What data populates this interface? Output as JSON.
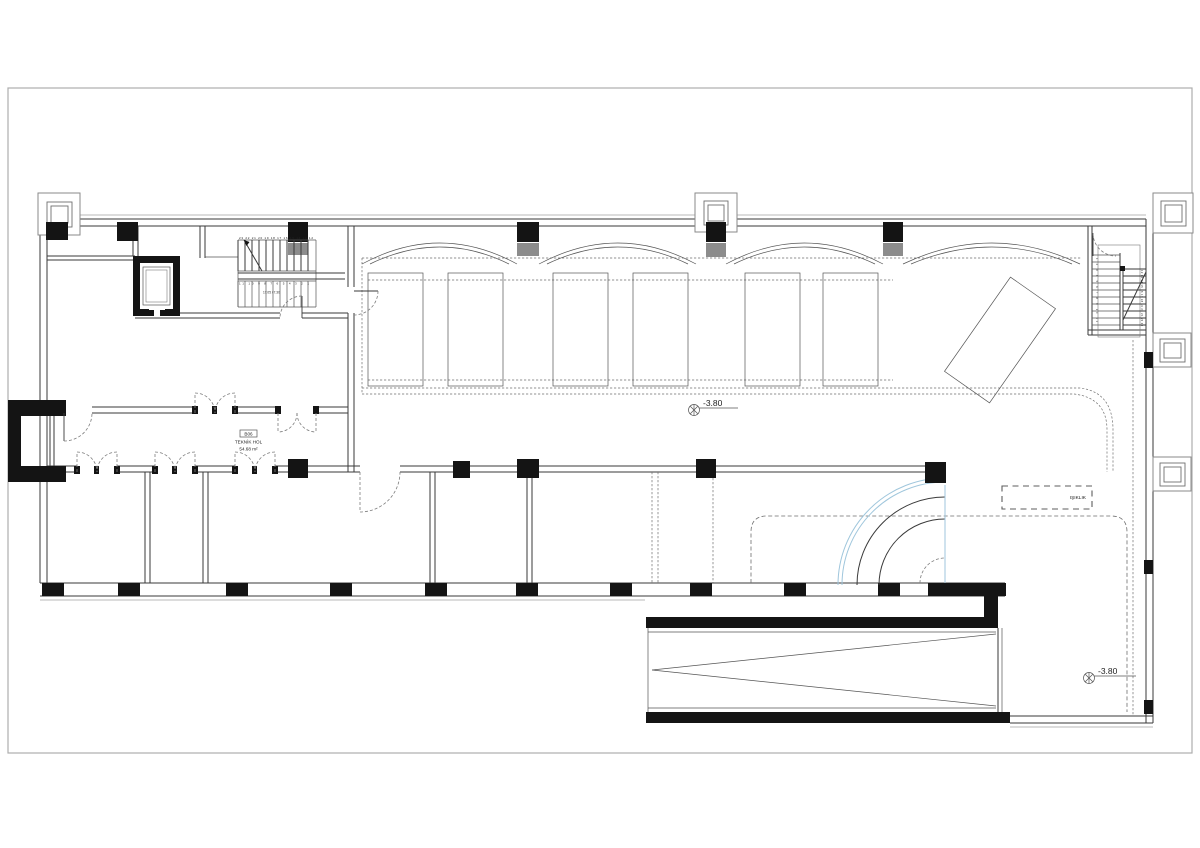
{
  "drawing": {
    "room_label": {
      "code": "B06",
      "name": "TEKNİK HOL",
      "area": "54.68 m²"
    },
    "levels": {
      "hall_level": "-3.80",
      "court_level": "-3.80"
    },
    "skylight_label": "IŞIKLIK",
    "stair_nw": {
      "upper_steps": "23 22 21 20 19 18 17 16 15 14 13 12",
      "lower_steps": "11 10 9 8 7 6 5 4 3 2 1",
      "note": "17.05 / 7.30"
    },
    "stair_ne": {
      "flight_a_steps": "1 2 3 4 5 6 7 8 9 10 11",
      "flight_b_steps": "12 13 14 15 16 17 18 19 20 21 22 23"
    }
  },
  "colors": {
    "wall_black": "#141414",
    "line_gray": "#3a3a3a",
    "dashed_gray": "#6e6e6e",
    "ramp_accent": "#9fc6dc",
    "column_pad_gray": "#8c8c8c",
    "page_border": "#adadad"
  }
}
